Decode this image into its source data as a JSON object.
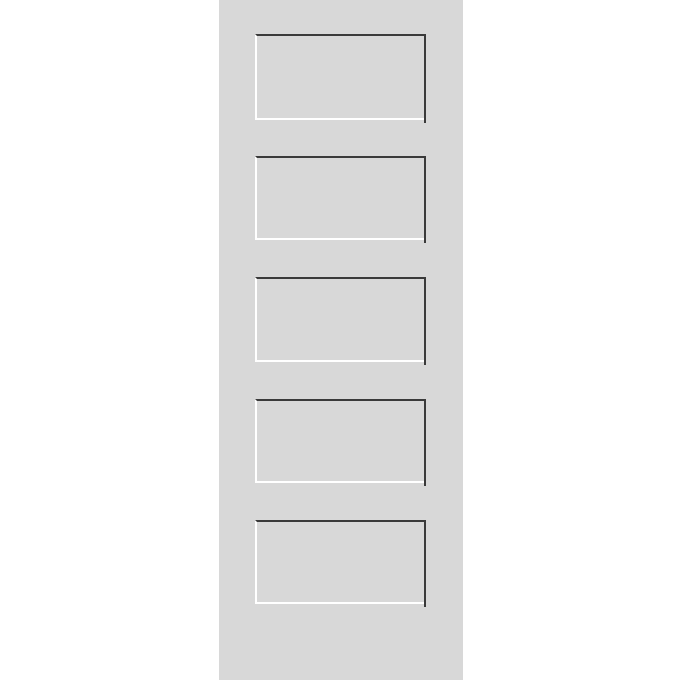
{
  "page": {
    "title": "5-Panel Shaker Door Slab",
    "description": "Primed light-gray 5-panel equal shaker style interior door slab shown upright on a plain white background. No text, labels, or controls are visible."
  },
  "door": {
    "style": "5-panel equal shaker",
    "panel_count": 5,
    "panels": [
      {
        "id": "panel-1",
        "position": "top"
      },
      {
        "id": "panel-2",
        "position": "upper-middle"
      },
      {
        "id": "panel-3",
        "position": "middle"
      },
      {
        "id": "panel-4",
        "position": "lower-middle"
      },
      {
        "id": "panel-5",
        "position": "bottom"
      }
    ]
  },
  "colors": {
    "background": "#ffffff",
    "door_face": "#d8d8d8",
    "panel_face": "#d8d8d8",
    "recess_shadow": "#3a3a3a",
    "recess_highlight": "#ffffff"
  }
}
